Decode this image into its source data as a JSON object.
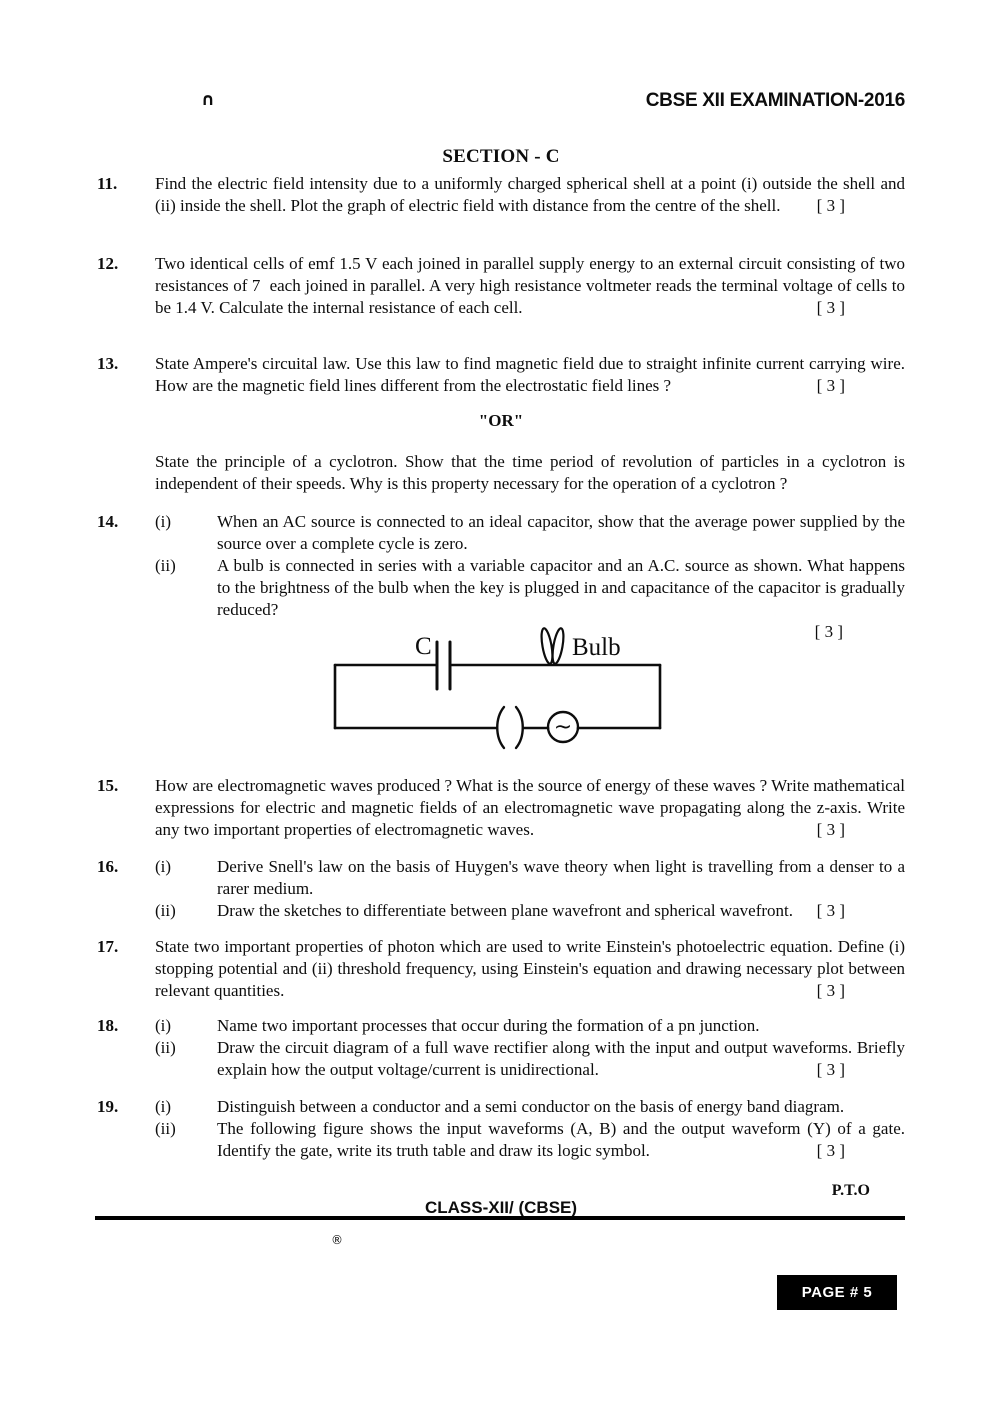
{
  "header": {
    "corner_glyph": "∩",
    "title": "CBSE XII EXAMINATION-2016"
  },
  "section": {
    "title": "SECTION - C"
  },
  "questions": {
    "q11": {
      "number": "11.",
      "text": "Find the electric field intensity due to a uniformly charged spherical shell at a point (i) outside the shell and (ii) inside the shell. Plot the graph of electric field with distance from the centre of the shell.",
      "marks": "[ 3 ]"
    },
    "q12": {
      "number": "12.",
      "text": "Two identical cells of emf 1.5 V each joined in parallel supply energy to an external circuit consisting of two resistances of 7  each joined in parallel. A very high resistance voltmeter reads the terminal voltage of cells to be 1.4 V. Calculate the internal resistance of each cell.",
      "marks": "[ 3 ]"
    },
    "q13": {
      "number": "13.",
      "text": "State Ampere's circuital law. Use this law to find magnetic field due to straight infinite current carrying wire. How are the magnetic field lines different from the electrostatic field lines ?",
      "marks": "[ 3 ]"
    },
    "or_block": {
      "label": "\"OR\"",
      "text": "State the principle of a cyclotron. Show that the time period of revolution of particles in a cyclotron is independent of their speeds. Why is this property necessary for the operation of a cyclotron ?"
    },
    "q14": {
      "number": "14.",
      "parts": {
        "i": {
          "label": "(i)",
          "text": "When an AC source is connected to an ideal capacitor, show that the average power supplied by the source over a complete cycle is zero."
        },
        "ii": {
          "label": "(ii)",
          "text": "A bulb is connected in series with a variable capacitor and an A.C. source as shown. What happens to the brightness of the bulb when the key is plugged in and capacitance of the capacitor is gradually reduced?"
        }
      },
      "marks": "[ 3 ]"
    },
    "q15": {
      "number": "15.",
      "text": "How are electromagnetic waves produced ? What is the source of energy of these waves ? Write mathematical expressions for electric and magnetic fields of an electromagnetic wave propagating along the z-axis. Write any two important properties of electromagnetic waves.",
      "marks": "[ 3 ]"
    },
    "q16": {
      "number": "16.",
      "parts": {
        "i": {
          "label": "(i)",
          "text": "Derive Snell's law on the basis of Huygen's wave theory when light is travelling from a denser to a rarer medium."
        },
        "ii": {
          "label": "(ii)",
          "text": "Draw the sketches to differentiate between plane wavefront and spherical wavefront.",
          "marks": "[ 3 ]"
        }
      }
    },
    "q17": {
      "number": "17.",
      "text": "State two important properties of photon which are used to write Einstein's photoelectric equation. Define (i) stopping potential and (ii) threshold frequency, using Einstein's equation and drawing necessary plot between relevant quantities.",
      "marks": "[ 3 ]"
    },
    "q18": {
      "number": "18.",
      "parts": {
        "i": {
          "label": "(i)",
          "text": "Name two important processes that occur during the formation of a pn junction."
        },
        "ii": {
          "label": "(ii)",
          "text": "Draw the circuit diagram of a full wave rectifier along with the input and output waveforms. Briefly explain how the output voltage/current is unidirectional.",
          "marks": "[ 3 ]"
        }
      }
    },
    "q19": {
      "number": "19.",
      "parts": {
        "i": {
          "label": "(i)",
          "text": "Distinguish between a conductor and a semi conductor on the basis of energy band diagram."
        },
        "ii": {
          "label": "(ii)",
          "text": "The following figure shows the input waveforms (A, B) and the output waveform (Y) of a gate. Identify the gate, write its truth table and draw its logic symbol.",
          "marks": "[ 3 ]"
        }
      }
    }
  },
  "figure": {
    "capacitor_label": "C",
    "bulb_label": "Bulb",
    "ac_symbol": "~"
  },
  "footer": {
    "pto": "P.T.O",
    "class_line": "CLASS-XII/ (CBSE)",
    "registered": "®",
    "page_badge": "PAGE # 5"
  }
}
